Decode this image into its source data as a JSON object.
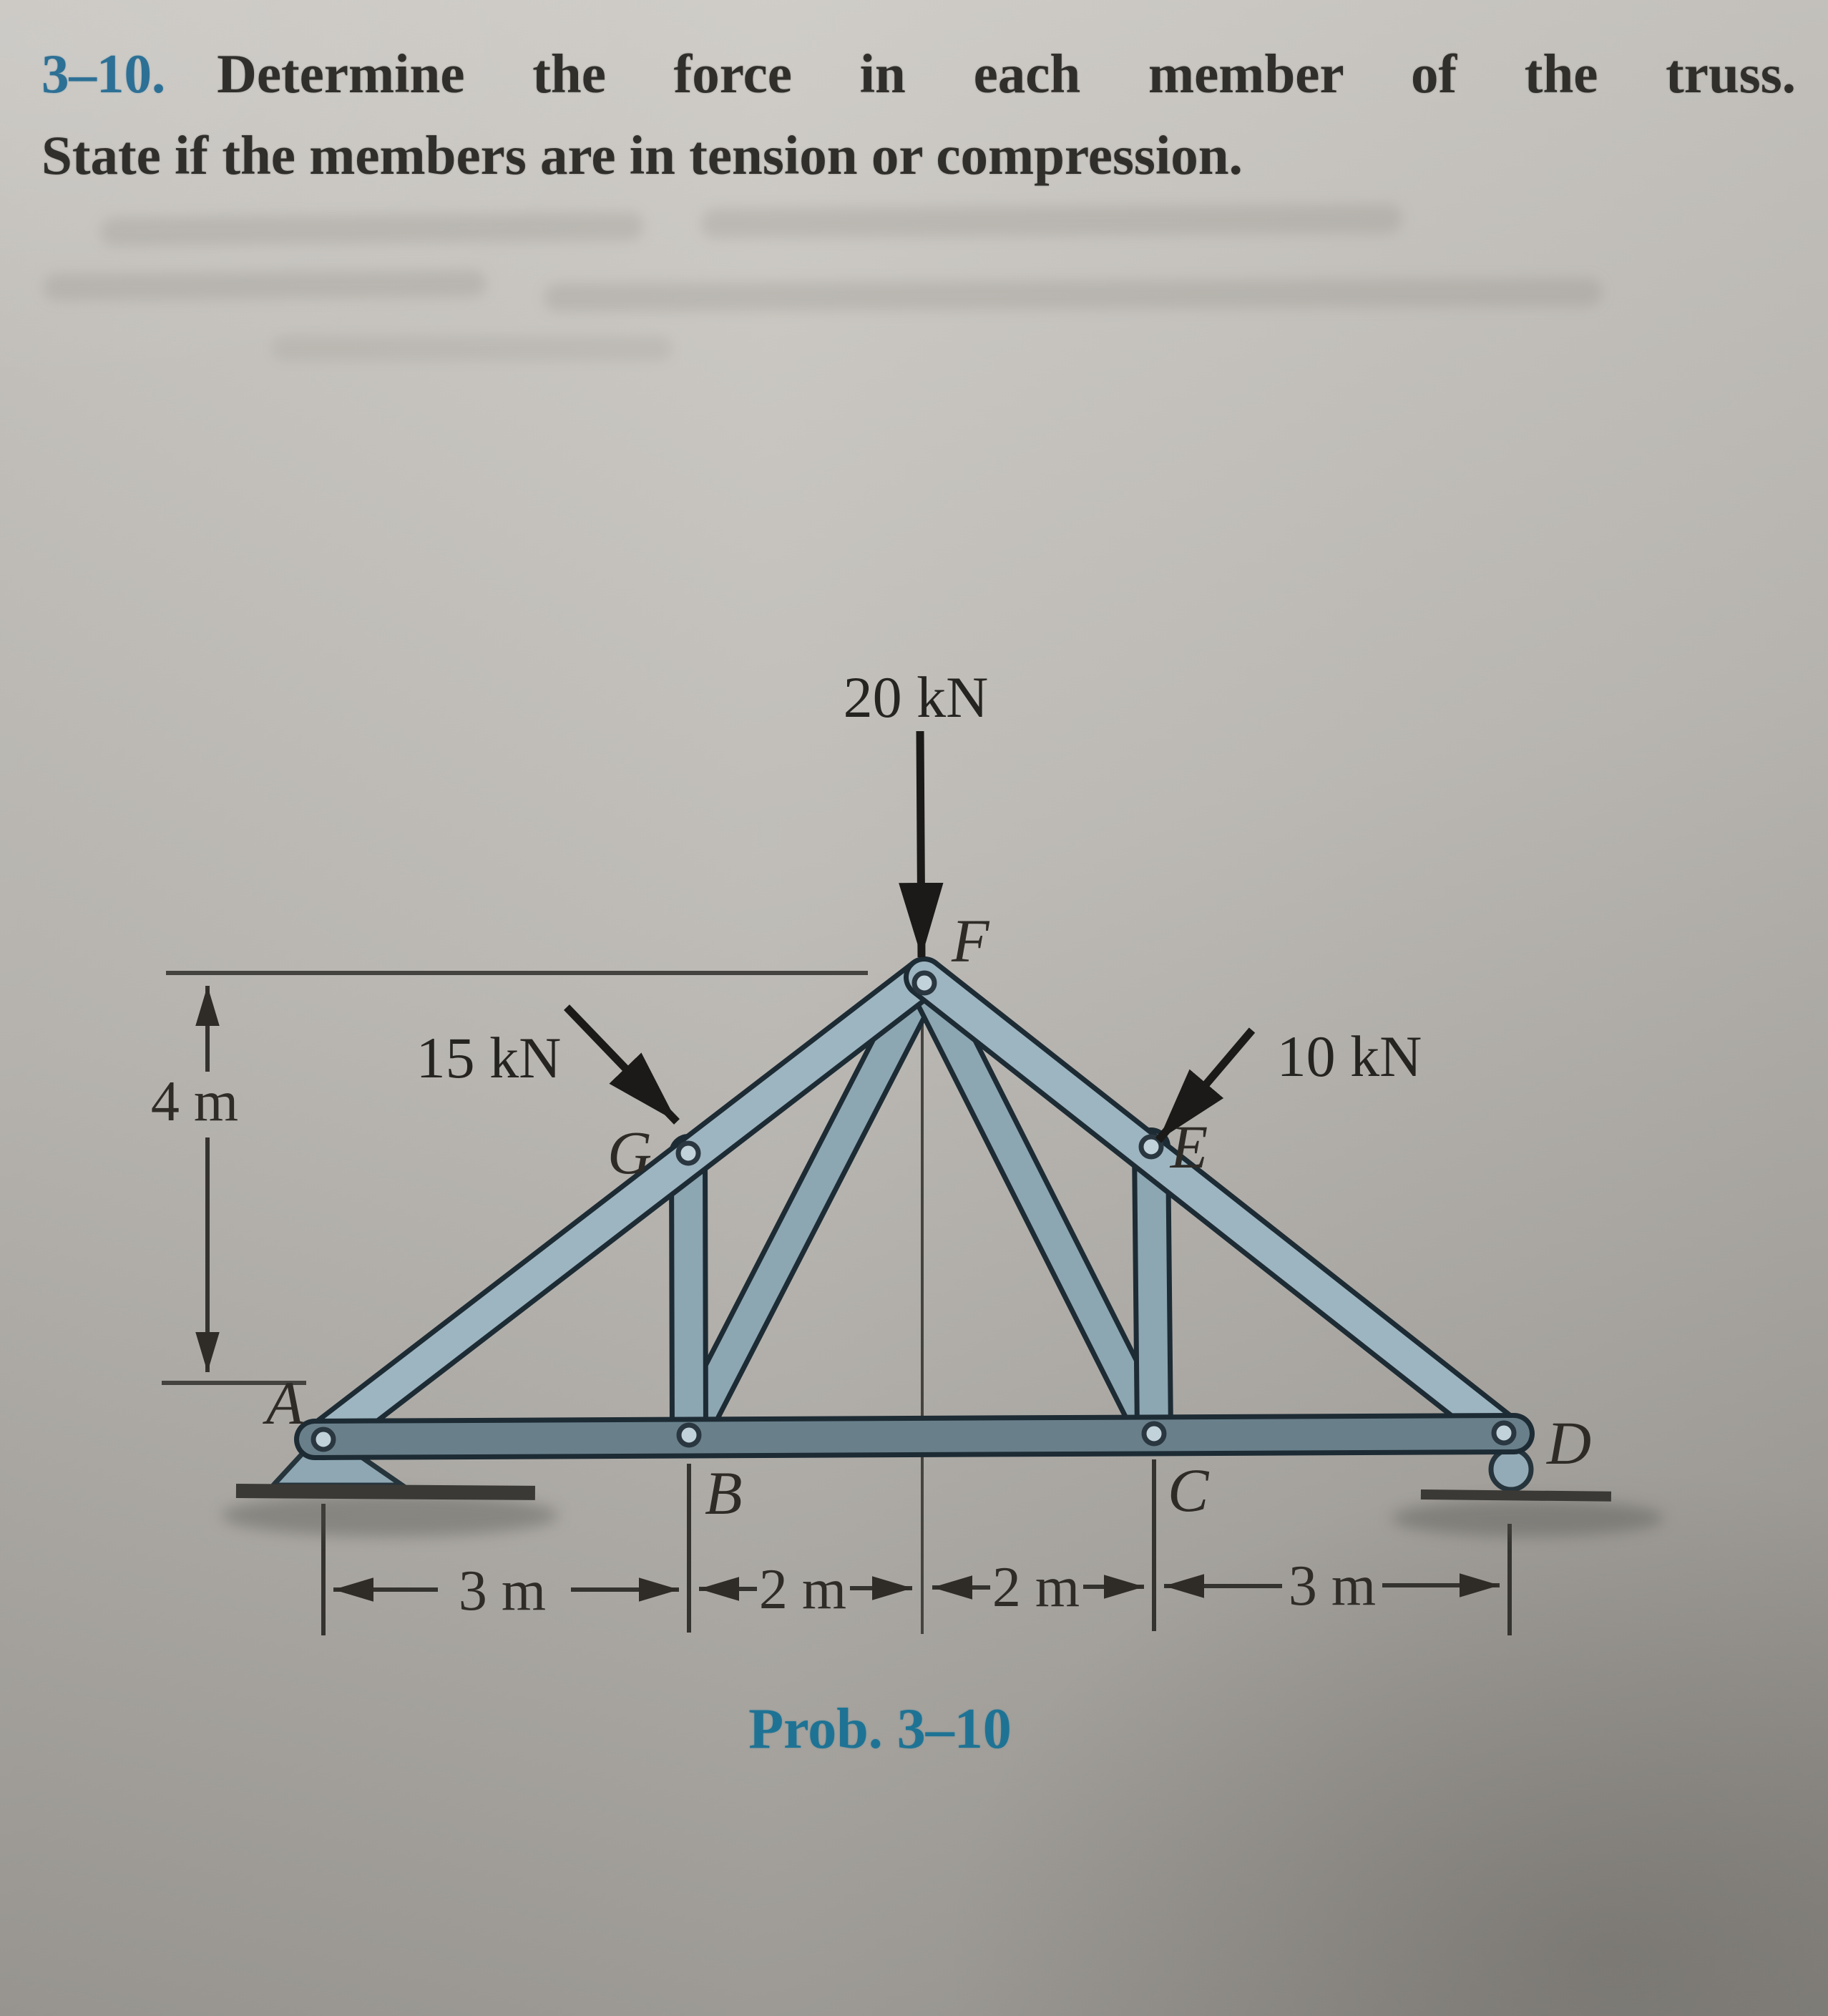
{
  "problem": {
    "number": "3–10.",
    "statement_line1": "Determine the force in each member of the truss.",
    "statement_line2": "State if the members are in tension or compression.",
    "caption": "Prob. 3–10"
  },
  "loads": {
    "at_F": "20 kN",
    "at_G": "15 kN",
    "at_E": "10 kN"
  },
  "dimensions": {
    "height": "4 m",
    "spans": [
      "3 m",
      "2 m",
      "2 m",
      "3 m"
    ]
  },
  "joint_labels": {
    "A": "A",
    "B": "B",
    "C": "C",
    "D": "D",
    "E": "E",
    "F": "F",
    "G": "G"
  },
  "supports": {
    "A": "pin",
    "D": "roller"
  },
  "colors": {
    "member_fill_light": "#9db5c0",
    "member_fill_dark": "#69808b",
    "member_outline": "#1d2b34",
    "accent_blue": "#2d7095",
    "caption_blue": "#1e7394",
    "ink": "#2f2c28",
    "paper": "#bcb9b4"
  }
}
